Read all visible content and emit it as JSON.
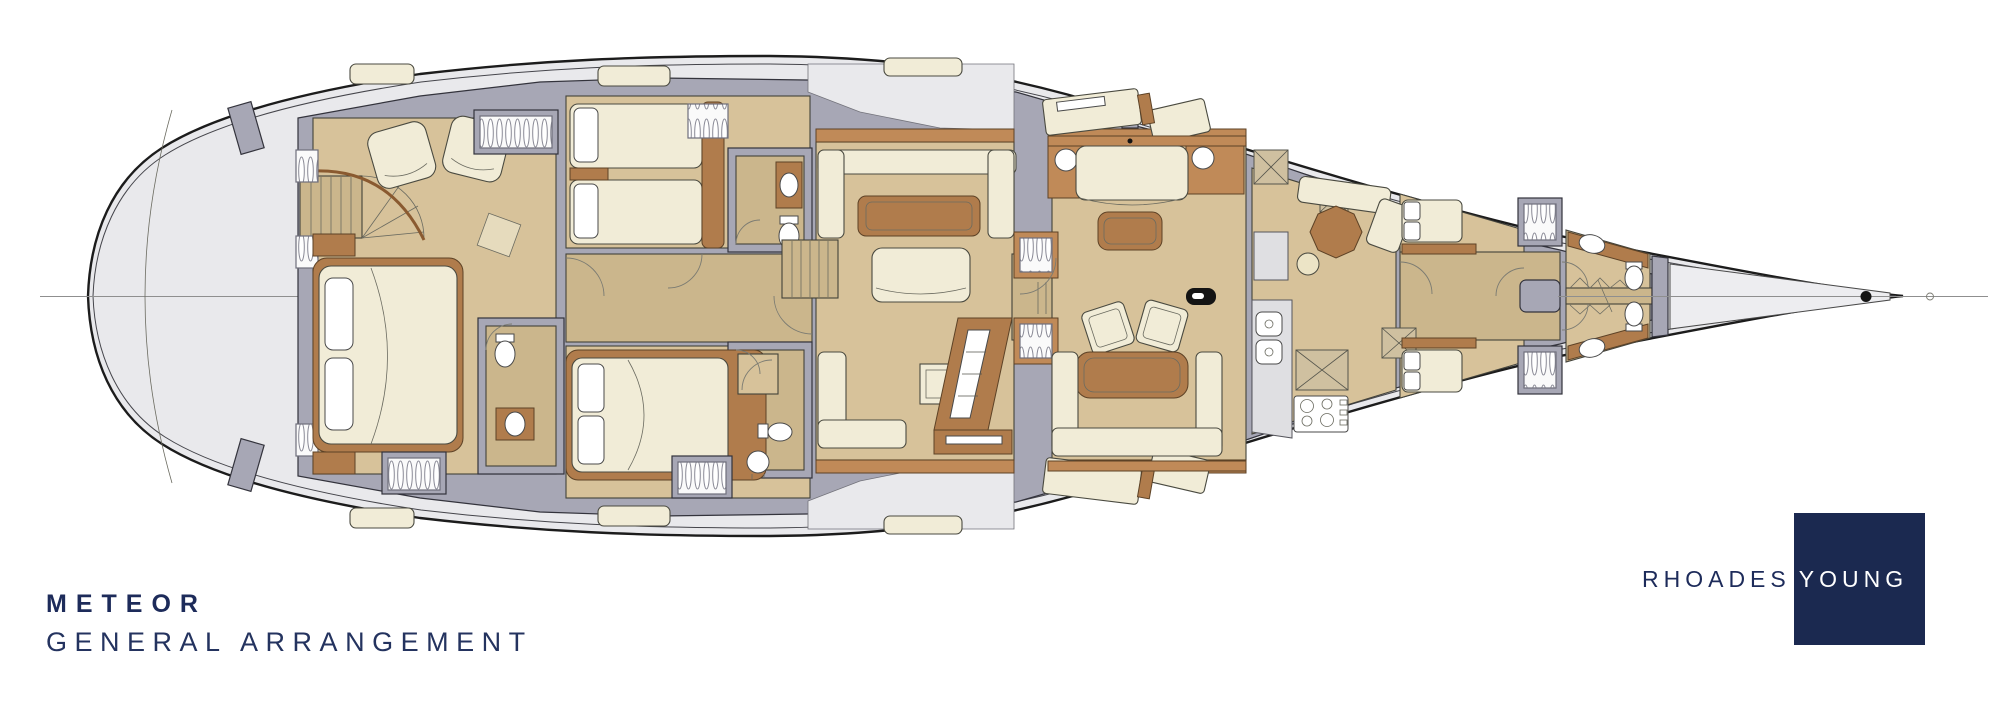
{
  "title_block": {
    "yacht_name": "METEOR",
    "drawing_title": "GENERAL ARRANGEMENT"
  },
  "logo": {
    "word_left": "RHOADES",
    "word_right": "YOUNG"
  },
  "palette": {
    "navy": "#1b2950",
    "hull_deck_gray": "#e9e9ec",
    "structure_gray": "#a7a7b5",
    "floor_tan": "#d7c29a",
    "corridor_tan": "#cbb68c",
    "wood_brown": "#b07c4c",
    "upholstery_cream": "#f1ecd7",
    "fixture_white": "#ffffff",
    "outline_dark": "#1c1c1c",
    "centerline_gray": "#8f8f8f"
  }
}
